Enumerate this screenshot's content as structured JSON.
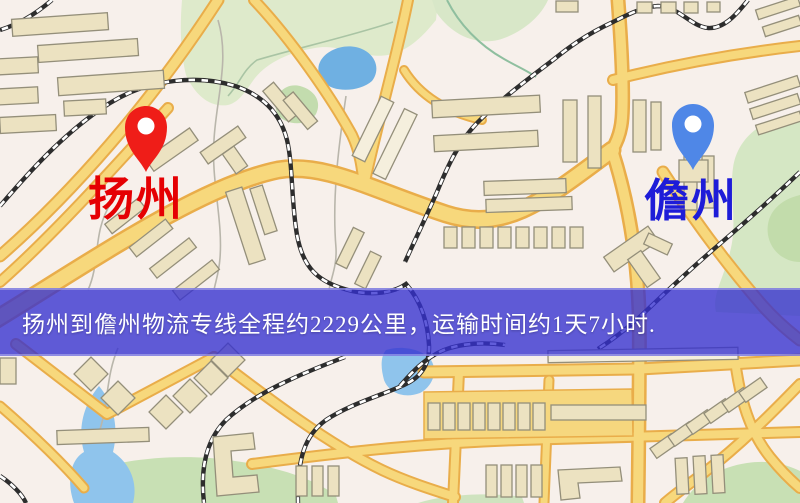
{
  "origin": {
    "label": "扬州"
  },
  "destination": {
    "label": "儋州"
  },
  "banner": {
    "text": "扬州到儋州物流专线全程约2229公里，运输时间约1天7小时."
  },
  "route": {
    "distance_text": "约2229公里",
    "duration_text": "约1天7小时"
  },
  "colors": {
    "origin_pin": "#ef1d18",
    "origin_label": "#e50003",
    "destination_pin": "#4f87e7",
    "destination_label": "#1e1cd8",
    "banner_bg": "rgba(52,48,208,0.78)",
    "road_fill": "#f7d87c",
    "road_casing": "#e9ad4a",
    "water": "#6fb0e2",
    "park": "#d5e7c4",
    "railway": "#2d2d2d",
    "background": "#f7f0eb"
  }
}
